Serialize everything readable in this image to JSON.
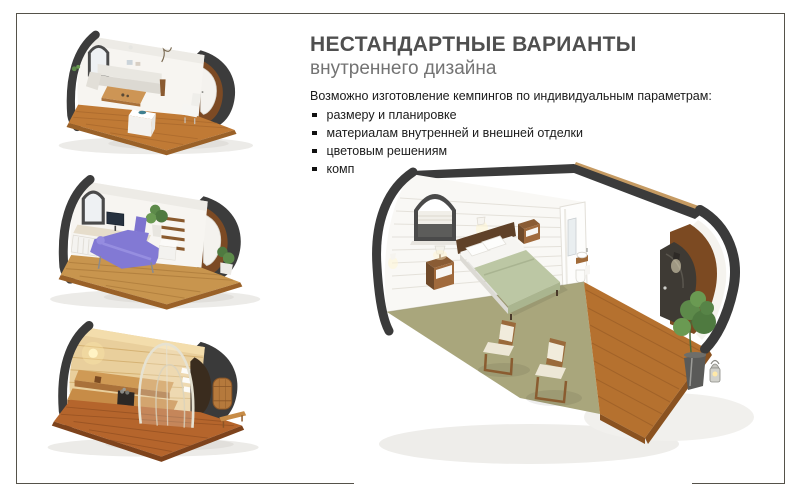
{
  "slide": {
    "title": "НЕСТАНДАРТНЫЕ ВАРИАНТЫ",
    "subtitle": "внутреннего дизайна",
    "intro": "Возможно изготовление кемпингов по индивидуальным параметрам:",
    "bullets": [
      "размеру и планировке",
      "материалам внутренней и внешней отделки",
      "цветовым решениям",
      "комплектации"
    ]
  },
  "images": {
    "dining": "dining-pod-interior-render",
    "office": "office-pod-interior-render",
    "sauna": "sauna-pod-interior-render",
    "bedroom": "bedroom-pod-interior-render"
  },
  "colors": {
    "title_text": "#4f4f4f",
    "subtitle_text": "#737373",
    "body_text": "#1b1b1b",
    "frame_border": "#55524a",
    "pod_shell": "#3b3b3b",
    "interior_wall": "#f7f5f1",
    "deck_wood": "#b5712f",
    "carpet_green": "#a9a67c",
    "bedding_green": "#bcc7a4",
    "sauna_wood": "#d19a55",
    "accent_purple": "#8279d4"
  }
}
